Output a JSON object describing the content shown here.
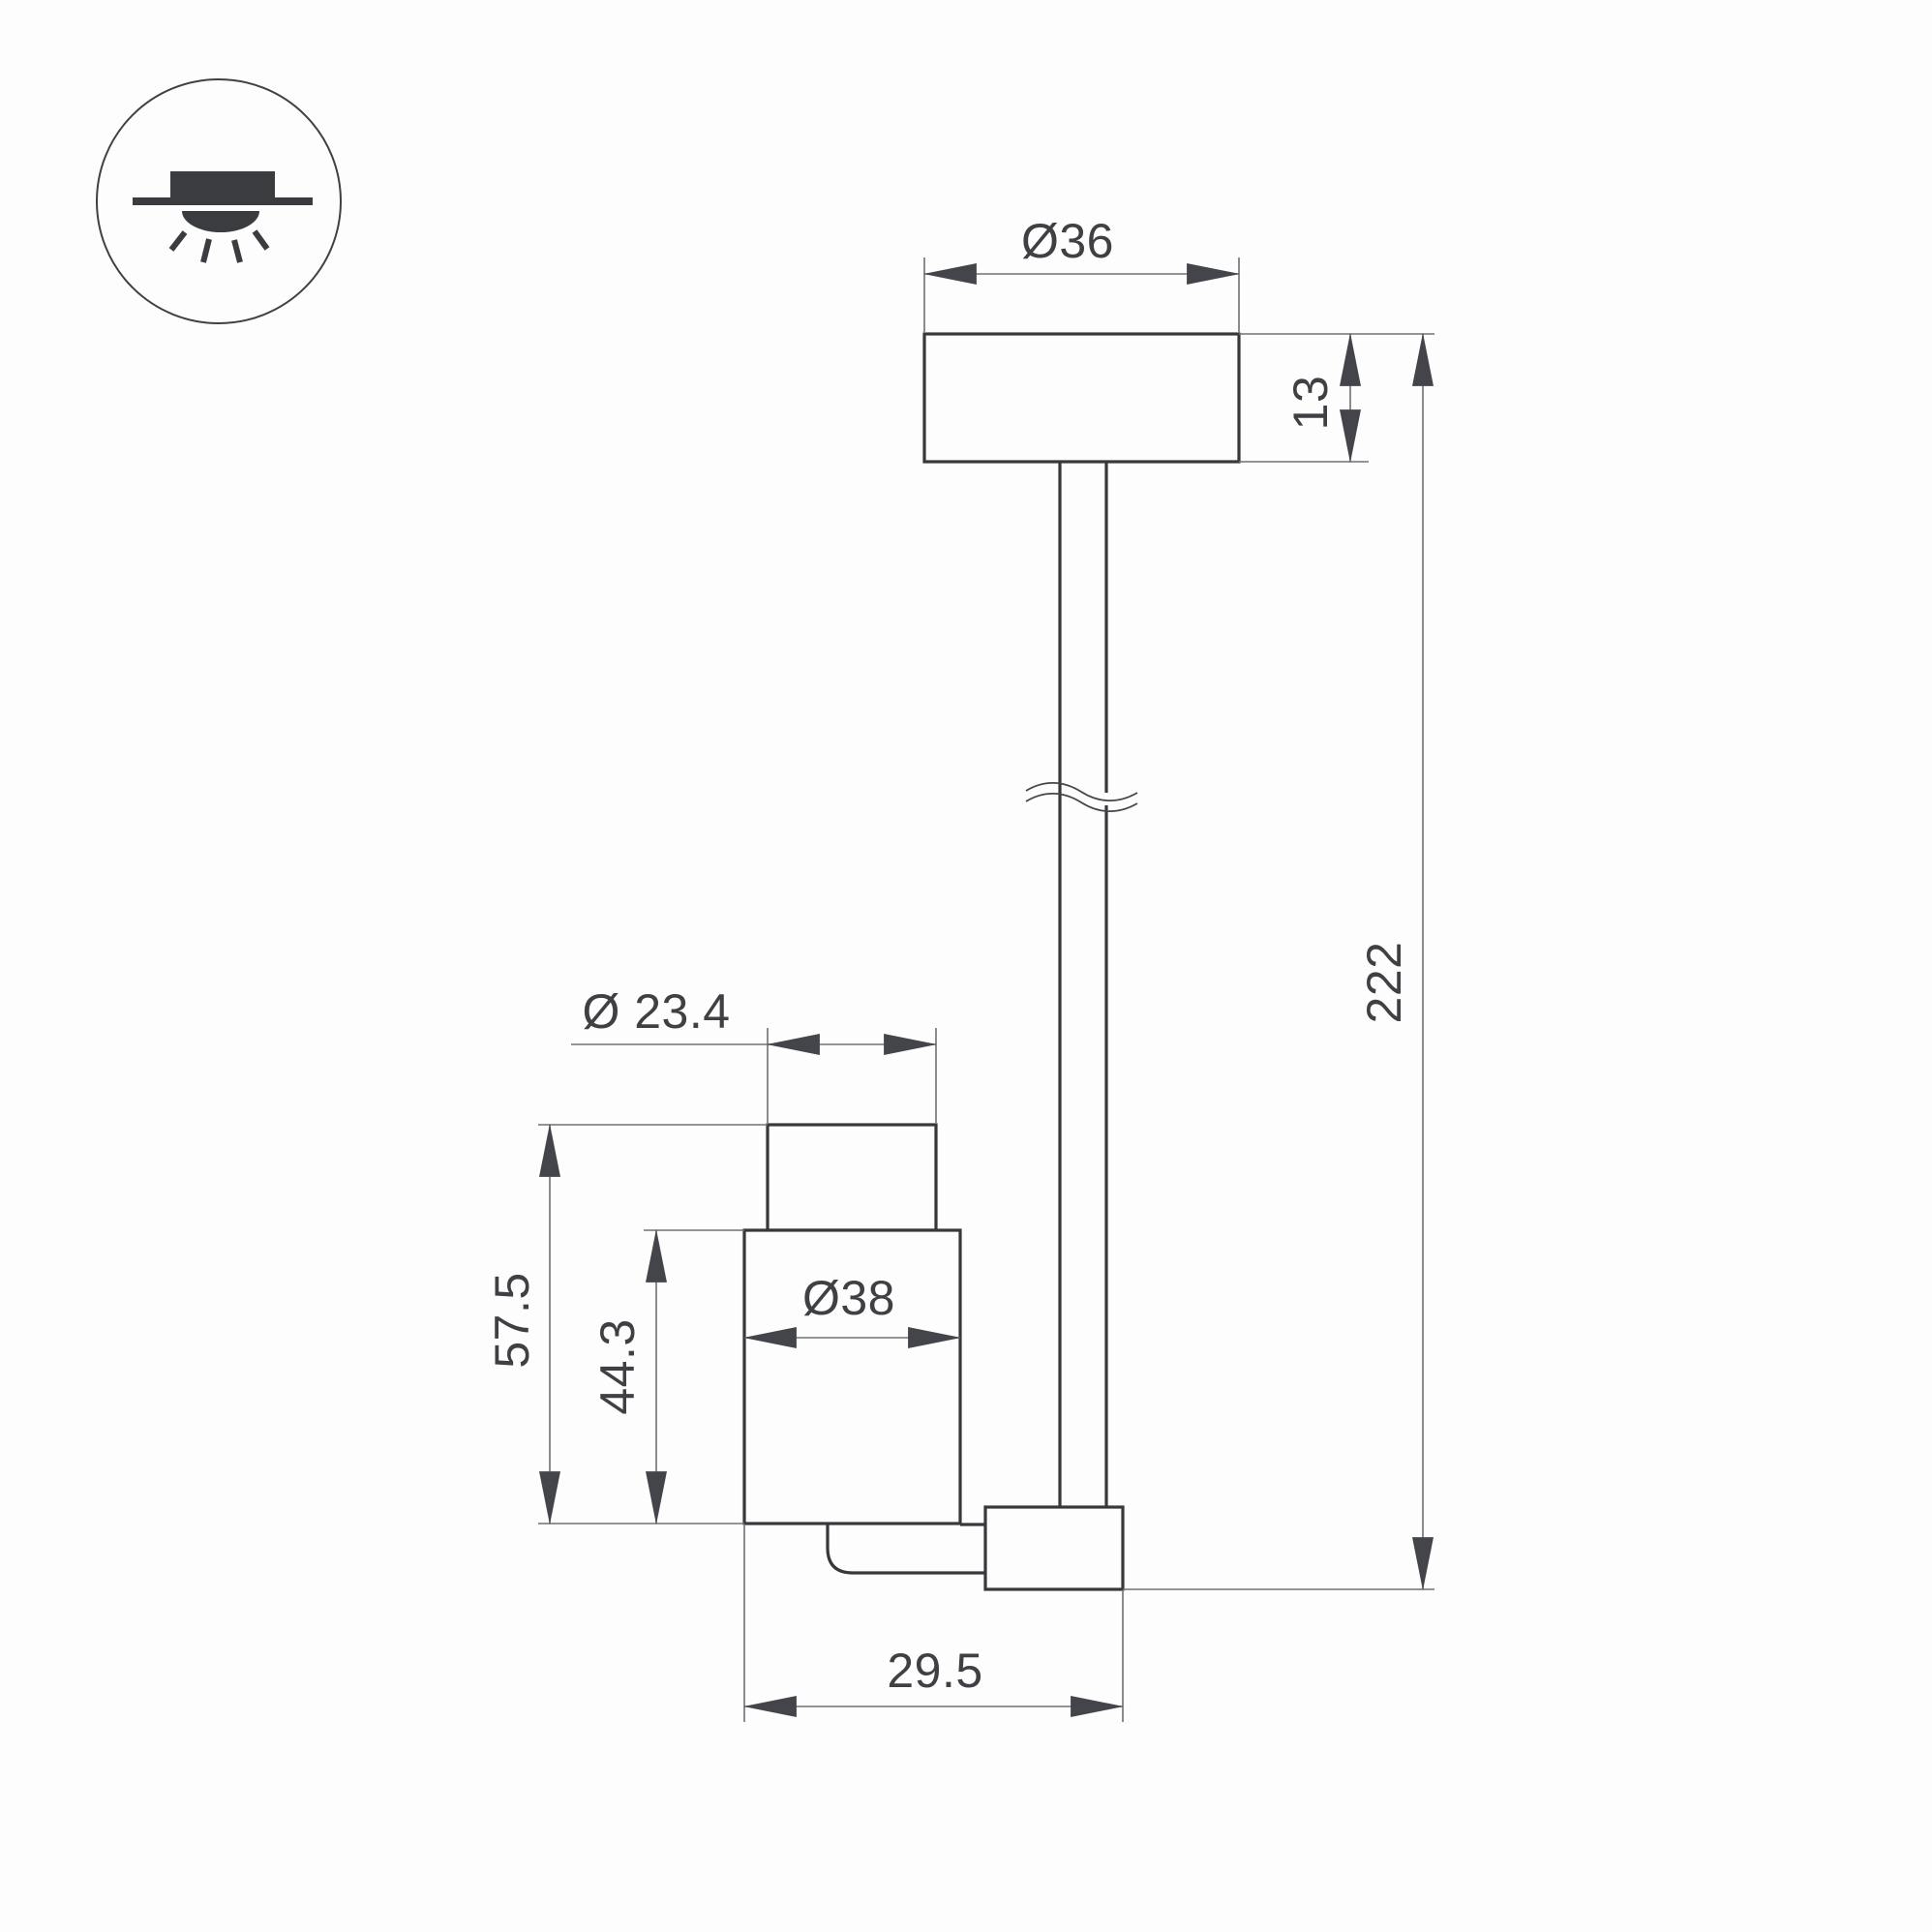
{
  "page": {
    "background": "#fdfdfd",
    "kind": "technical dimensional drawing of ceiling pendant spot light"
  },
  "icon": {
    "semantic": "recessed-ceiling-light-icon"
  },
  "dim_labels": {
    "canopy_diameter": "Ø36",
    "canopy_height": "13",
    "overall_length": "222",
    "barrel_diameter": "Ø 23.4",
    "head_height": "57.5",
    "body_height": "44.3",
    "body_diameter": "Ø38",
    "head_depth": "29.5"
  },
  "colors": {
    "outline": "#36383b",
    "dimension_line": "#6e7174",
    "arrow": "#43454a",
    "label_text": "#3e4043",
    "icon_fill": "#3a3c3f"
  }
}
